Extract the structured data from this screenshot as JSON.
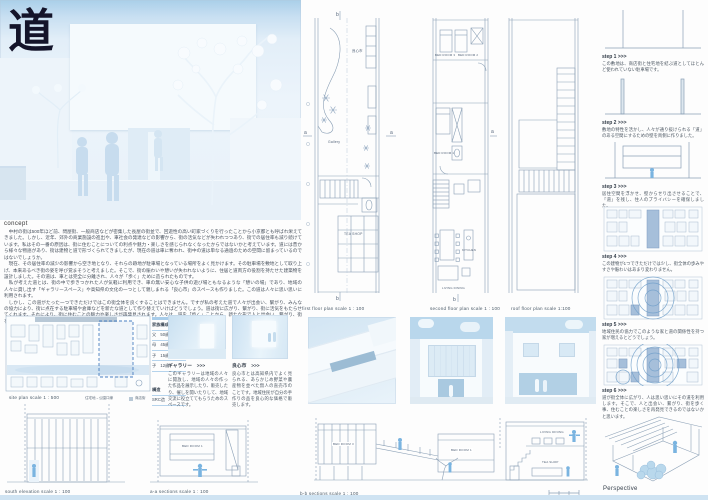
{
  "title": {
    "kanji": "道"
  },
  "concept": {
    "label": "concept",
    "text": "　中村の街は500年ほど前、問屋街、一般商店などが密集した長屋の街並で、回遊性の高い町家づくりを行ったことから小京都とも呼ばれ栄えてきました。しかし、近年、郊外の商業施設の進出や、車社会の発達などの影響から、街の活気などが失われつつあり、街での居住率も減り続けています。私はその一番の原因は、街に住むことについての利点や魅力・楽しさを感じられなくなったからではないかと考えています。道には昔から様々な物語があり、街は建物と道で形づくられてきましたが、現在の道は車に奪われ、街中の道は単なる通過のための空間に留まっているのではないでしょうか。\n　現在、その居住率の減少の影響から空き地となり、それらの跡地が駐車場となっている場所をよく見かけます。その駐車場を敷地として取り上げ、本来あるべき街の姿を呼び覚まそうと考えました。そこで、街の賑わいや憩いが失われないように、住居と道両方の役割を持たせた建築物を設計しました。その道は、車とは完全に分離され、人々が「歩く」ために造られたものです。\n　私が考えた道とは、街の中で歩きつかれた人が気軽に利用でき、車の無い安心な子供の遊び場ともなるような「憩いの場」であり、地域の人々に貸し出す「ギャラリースペース」や高知県の文化の一つとして親しまれる「良心市」のスペースも作りました。この道は人々に思い思いに利用されます。\n　しかし、この道がたった一つできただけではこの街全体を良くすることはできません。ですが私の考えた道で人々が出会い、繋がり、みんなの協力により、街に点在する駐車場や倉庫などを新たな道として作り替えていけばどうでしょう。道は街に広がり、繋がり、街に活気をもたらせてくれます。それにより、街に住むことの魅力や楽しさが再発見されます。人々は、道を「歩く」ことから、新たな形で人と出会い、繋がり、街を歩くこと、住むことの本当の楽しさ、喜びを感じられるでしょう。"
  },
  "marks": {
    "a": "a",
    "b": "b"
  },
  "rooms": {
    "bed1": "BED ROOM 1",
    "bed2": "BED ROOM 2",
    "bed3": "BED ROOM 3",
    "kitchen": "KITCHEN",
    "living": "LIVING DINING",
    "tea": "TEA SHOP",
    "gallery": "Gallery",
    "ryoshin": "良心市"
  },
  "plans": [
    {
      "caption": "first floor plan  scale  1 : 100"
    },
    {
      "caption": "second floor plan  scale  1 : 100"
    },
    {
      "caption": "roof floor plan  scale  1:100"
    }
  ],
  "steps": [
    {
      "label": "step 1 >>>",
      "text": "この敷地は、商店街と住宅地を結ぶ道としてほとんど使われていない駐車場です。"
    },
    {
      "label": "step 2 >>>",
      "text": "敷地の特性を活かし、人々が通り抜けられる「道」のある空間にするための壁を両側に作りました。"
    },
    {
      "label": "step 3 >>>",
      "text": "居住空間を浮かせ、壁からせり出させることで、「道」を残し、住人のプライバシーを確保しました。"
    },
    {
      "label": "step 4 >>>",
      "text": "この建物が1つできただけでは少し、街全体の歩みやすさや賑わいはあまり変わりません。"
    },
    {
      "label": "step 5 >>>",
      "text": "地域住民の協力でこのような家と道の関係性を持つ家が増えるとどうでしょう。"
    },
    {
      "label": "step 6 >>>",
      "text": "道が街全体に広がり、人は思い思いにその道を利用します。そこで、人と出会い、繋がり、街を歩く事、住むことの楽しさを再発見できるのではないかと思います。"
    }
  ],
  "perspective": {
    "label": "Perspective"
  },
  "site": {
    "caption": "site plan  scale  1 : 500",
    "legend_road": "住宅地→公園口線",
    "legend_shop": "商店街"
  },
  "family": {
    "heading": "家族構成",
    "members": [
      "父　50歳",
      "母　45歳",
      "子　15歳",
      "子　12歳"
    ],
    "structure_heading": "構造",
    "structure_value": "SRC造"
  },
  "photos": [
    {
      "caption": "ギャラリー　>>>",
      "text": "このギャラリーは地域の人々に開放し、地域の人々の作った作品を展示したり、販売したり、催しを開いたりして、地域交流に役立ててもらうためのスペースです。"
    },
    {
      "caption": "良心市　>>>",
      "text": "良心市とは高知県内でよく見られる、あらかじめ野菜や農産物を並べた無人の直売市のことです。地域住民が自分の手作りの品を良心的な価格で販売します。"
    }
  ],
  "sections": {
    "south": {
      "caption": "south elevation scale  1 : 100"
    },
    "aa": {
      "caption": "a-a  sections  scale   1 : 100"
    },
    "bb": {
      "caption": "b-b  sections  scale  1 : 100"
    }
  },
  "colors": {
    "accent_blue": "#4a7fc1",
    "figure_blue": "#7ab4e0",
    "sky_blue": "#aecfe8",
    "line_gray": "#8a9fb5"
  }
}
